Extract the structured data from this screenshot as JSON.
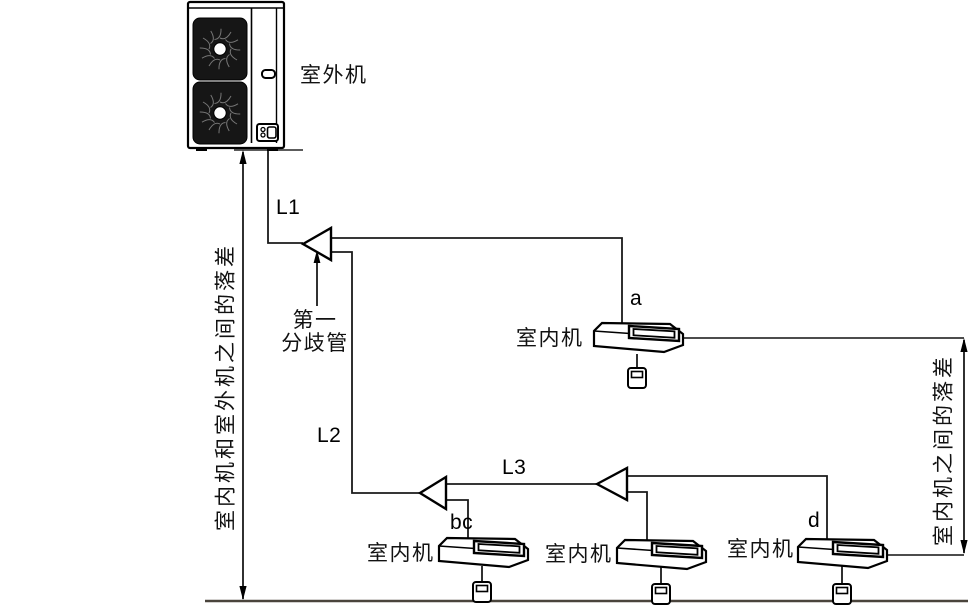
{
  "outdoor_unit": {
    "label": "室外机"
  },
  "branch": {
    "label_line1": "第一",
    "label_line2": "分歧管"
  },
  "pipes": {
    "l1": "L1",
    "l2": "L2",
    "l3": "L3"
  },
  "indoor_units": [
    {
      "id": "a",
      "label": "室内机"
    },
    {
      "id": "bc",
      "label": "室内机"
    },
    {
      "id": "",
      "label": "室内机"
    },
    {
      "id": "d",
      "label": "室内机"
    }
  ],
  "dimensions": {
    "outdoor_indoor": "室内机和室外机之间的落差",
    "indoor_indoor": "室内机之间的落差"
  },
  "colors": {
    "line": "#000000",
    "ground": "#4a443c",
    "background": "#ffffff"
  }
}
